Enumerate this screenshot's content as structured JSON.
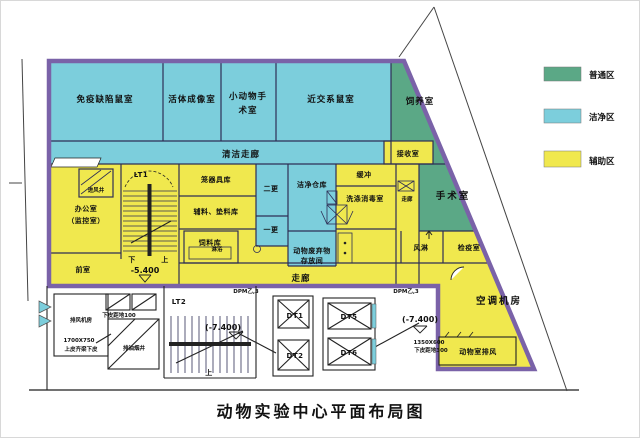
{
  "title": "动物实验中心平面布局图",
  "legend": {
    "general": {
      "label": "普通区",
      "color": "#5BA886"
    },
    "clean": {
      "label": "洁净区",
      "color": "#7CCEDC"
    },
    "auxiliary": {
      "label": "辅助区",
      "color": "#F0E84E"
    }
  },
  "wall_color": "#7A62A8",
  "rooms": {
    "immune_mouse": "免疫缺陷鼠室",
    "live_imaging": "活体成像室",
    "small_animal_surgery_l1": "小动物手",
    "small_animal_surgery_l2": "术室",
    "inbred_mouse": "近交系鼠室",
    "feeding": "饲养室",
    "clean_corridor": "清洁走廊",
    "receiving": "接收室",
    "cage_storage": "笼器具库",
    "aux_bedding_storage": "辅料、垫料库",
    "feed_storage": "饲料库",
    "second_change": "二更",
    "first_change": "一更",
    "shower": "淋浴",
    "clean_warehouse": "洁净仓库",
    "buffer": "缓冲",
    "washing_disinfection": "洗涤消毒室",
    "corridor_right": "走廊",
    "surgery": "手术室",
    "air_shower": "风淋",
    "quarantine": "检疫室",
    "waste_l1": "动物废弃物",
    "waste_l2": "存放间",
    "corridor_bottom": "走廊",
    "office": "办公室",
    "office_sub": "（监控室）",
    "air_intake_shaft": "进风井",
    "front_room": "前室",
    "ac_plant": "空调机房",
    "animal_exhaust": "动物室排风",
    "exhaust_fan_room": "排风机房",
    "oil_fume_shaft": "排油烟井"
  },
  "stairs": {
    "lt1": "LT1",
    "lt2": "LT2",
    "down": "下",
    "up": "上",
    "up2": "上"
  },
  "elevators": {
    "dt1": "DT1",
    "dt2": "DT2",
    "dt5": "DT5",
    "dt6": "DT6"
  },
  "levels": {
    "b1": "-5.400",
    "b2_left": "(-7.400)",
    "b2_right": "(-7.400)"
  },
  "annotations": {
    "door_tag_left": "DPM乙,3",
    "door_tag_right": "DPM乙,3",
    "dim_oil_shaft": "1700X750",
    "note_oil_shaft": "上皮齐梁下皮",
    "note_shaft": "下皮距地100",
    "dim_exhaust": "1350X600",
    "note_exhaust": "下皮距地300"
  }
}
